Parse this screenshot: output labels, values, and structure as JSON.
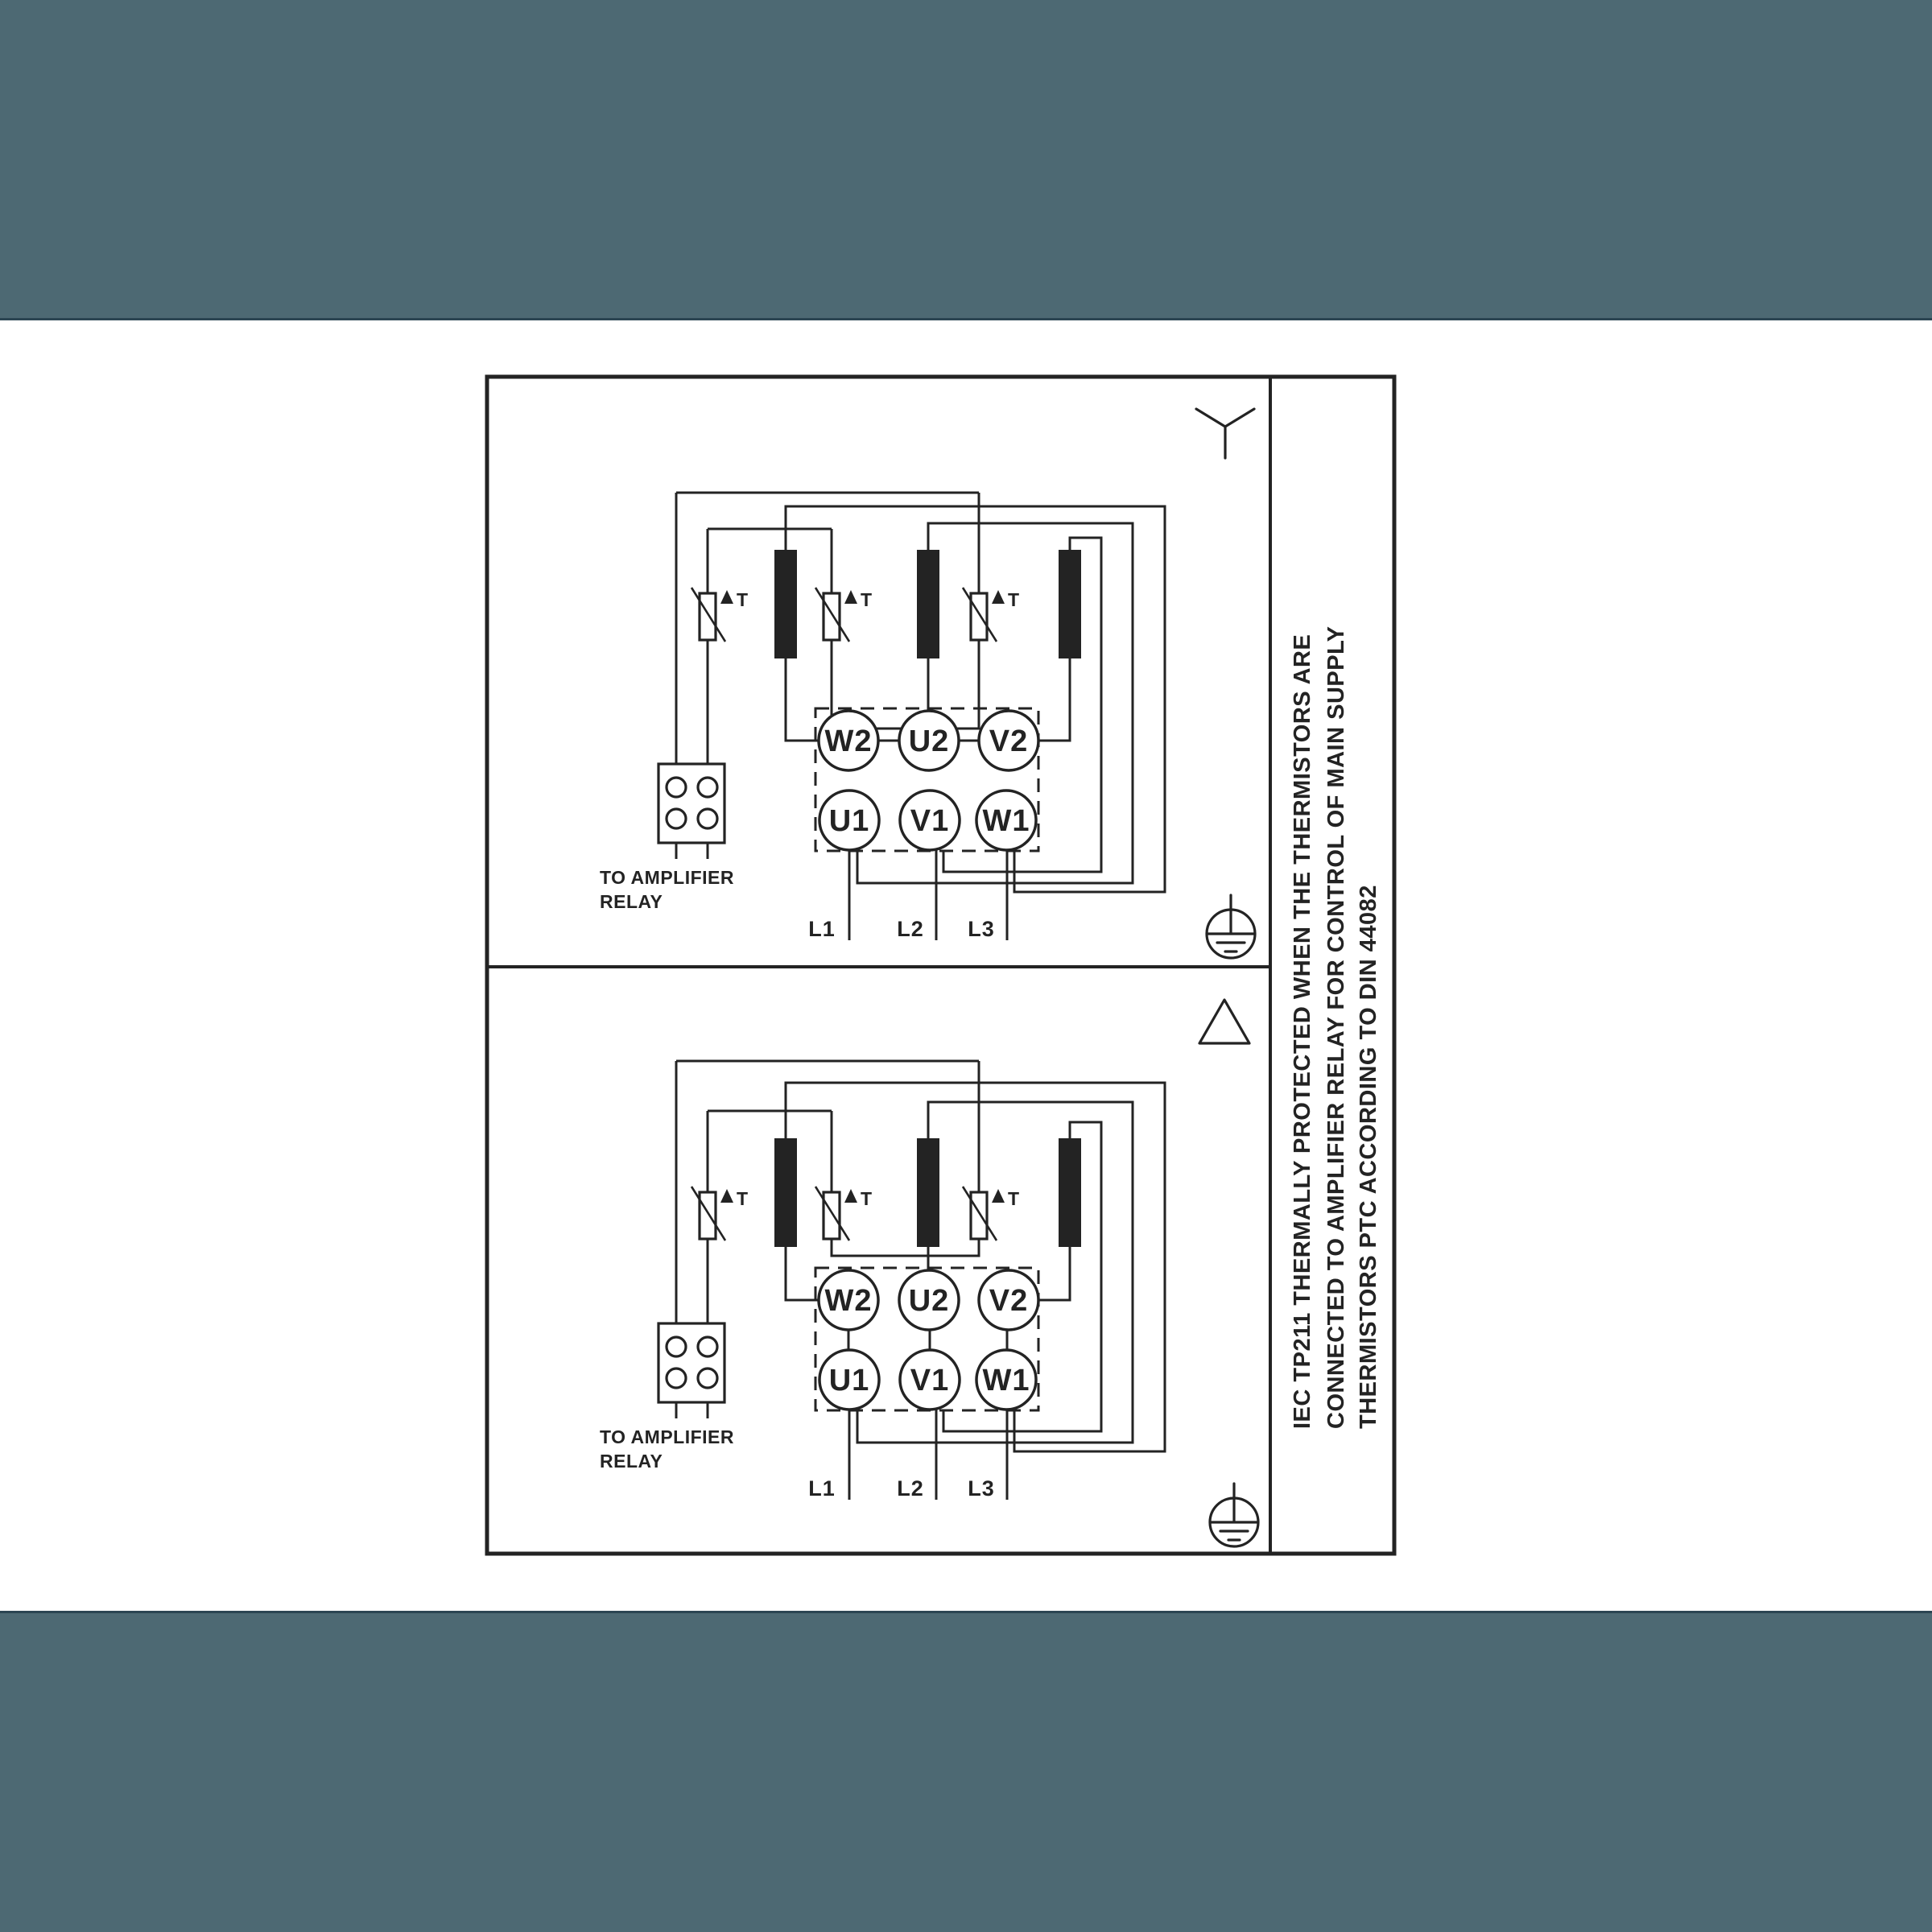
{
  "colors": {
    "paper": "#ffffff",
    "letterbox": "#4d6973",
    "letterbox_edge": "#2b4552",
    "ink": "#232323"
  },
  "sidebar_note": {
    "line1": "IEC TP211 THERMALLY PROTECTED WHEN THE THERMISTORS ARE",
    "line2": "CONNECTED TO AMPLIFIER RELAY FOR CONTROL OF MAIN SUPPLY",
    "line3": "THERMISTORS PTC ACCORDING TO DIN 44082"
  },
  "panels": [
    {
      "connection": "star",
      "terminals": {
        "w2": "W2",
        "u2": "U2",
        "v2": "V2",
        "u1": "U1",
        "v1": "V1",
        "w1": "W1"
      },
      "supply": {
        "l1": "L1",
        "l2": "L2",
        "l3": "L3"
      },
      "relay_note": {
        "line1": "TO AMPLIFIER",
        "line2": "RELAY"
      },
      "thermistor_tag": "T"
    },
    {
      "connection": "delta",
      "terminals": {
        "w2": "W2",
        "u2": "U2",
        "v2": "V2",
        "u1": "U1",
        "v1": "V1",
        "w1": "W1"
      },
      "supply": {
        "l1": "L1",
        "l2": "L2",
        "l3": "L3"
      },
      "relay_note": {
        "line1": "TO AMPLIFIER",
        "line2": "RELAY"
      },
      "thermistor_tag": "T"
    }
  ]
}
